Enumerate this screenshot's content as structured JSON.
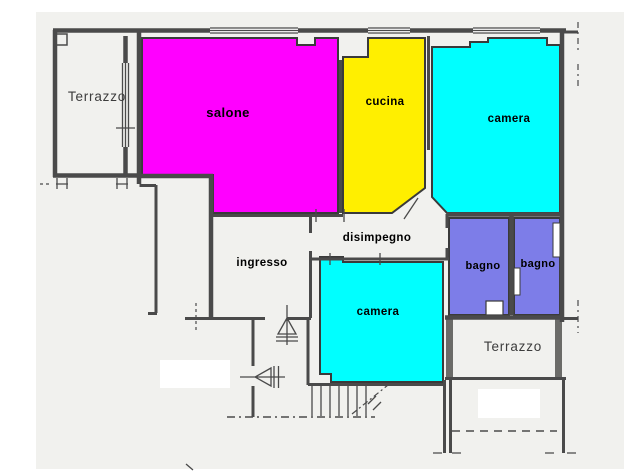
{
  "title": "Planimetria appartamento",
  "colors": {
    "paper": "#F1F1EE",
    "white": "#FFFFFF",
    "wall": "#4A4A4A",
    "wall_hatch": "#6B6B68",
    "room_stroke": "#3A3A3A",
    "salone": "#FF00FF",
    "cucina": "#FFEF00",
    "camera": "#00FFFF",
    "bagno": "#7D7DE8",
    "label": "#000000",
    "terrazzo_label": "#3C3C3C",
    "faint": "#9A9A96"
  },
  "rooms": {
    "terrazzo_top_left": {
      "label": "Terrazzo"
    },
    "salone": {
      "label": "salone"
    },
    "cucina": {
      "label": "cucina"
    },
    "camera_top_right": {
      "label": "camera"
    },
    "disimpegno": {
      "label": "disimpegno"
    },
    "ingresso": {
      "label": "ingresso"
    },
    "camera_bottom": {
      "label": "camera"
    },
    "bagno_left": {
      "label": "bagno"
    },
    "bagno_right": {
      "label": "bagno"
    },
    "terrazzo_bottom_right": {
      "label": "Terrazzo"
    }
  }
}
